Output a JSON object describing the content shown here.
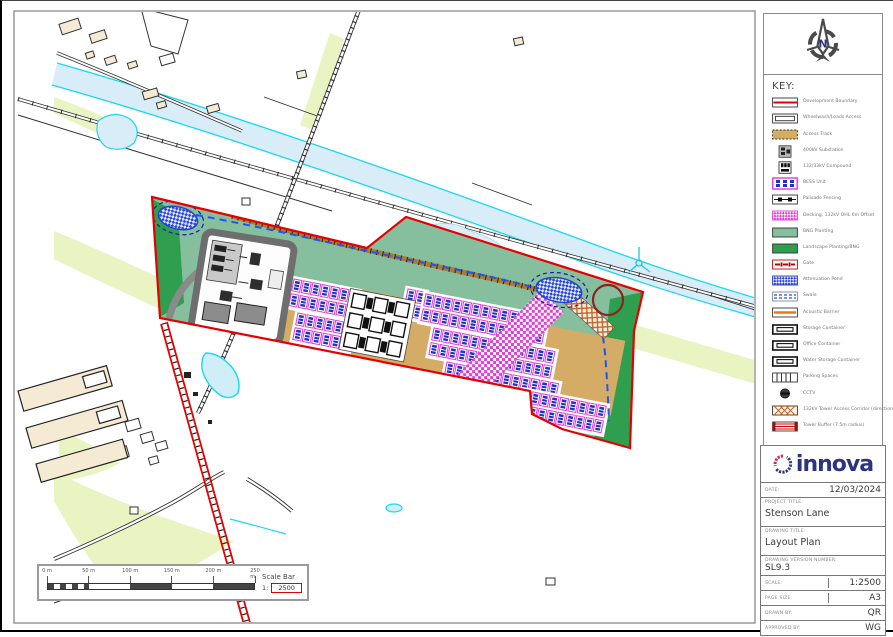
{
  "sheet": {
    "compass": {
      "letter": "N"
    },
    "key": {
      "title": "KEY:",
      "items": [
        {
          "label": "Development Boundary",
          "type": "boundary"
        },
        {
          "label": "Wheelwash/Loads Access",
          "type": "double"
        },
        {
          "label": "Access Track",
          "type": "track"
        },
        {
          "label": "400kV Substation",
          "type": "substation"
        },
        {
          "label": "132/33kV Compound",
          "type": "compound"
        },
        {
          "label": "BESS Unit",
          "type": "bess"
        },
        {
          "label": "Palisade Fencing",
          "type": "palisade"
        },
        {
          "label": "Decking, 132kV OHL 6m Offset",
          "type": "magcheck"
        },
        {
          "label": "BNG Planting",
          "type": "lightgreen"
        },
        {
          "label": "Landscape Planting/BNG",
          "type": "darkgreen"
        },
        {
          "label": "Gate",
          "type": "gate"
        },
        {
          "label": "Attenuation Pond",
          "type": "bluecheck"
        },
        {
          "label": "Swale",
          "type": "swale"
        },
        {
          "label": "Acoustic Barrier",
          "type": "acoustic"
        },
        {
          "label": "Storage Container",
          "type": "container"
        },
        {
          "label": "Office Container",
          "type": "container"
        },
        {
          "label": "Water Storage Container",
          "type": "container"
        },
        {
          "label": "Parking Spaces",
          "type": "parking"
        },
        {
          "label": "CCTV",
          "type": "cctv"
        },
        {
          "label": "132kV Tower Access Corridor (directional)",
          "type": "xhatch"
        },
        {
          "label": "Tower Buffer (7.5m radius)",
          "type": "redhatch"
        }
      ]
    },
    "logo": {
      "text": "innova"
    },
    "titleblock": {
      "date_label": "DATE:",
      "date": "12/03/2024",
      "project_label": "PROJECT TITLE:",
      "project": "Stenson Lane",
      "drawing_label": "DRAWING TITLE:",
      "drawing": "Layout Plan",
      "version_label": "DRAWING VERSION NUMBER:",
      "version": "SL9.3",
      "scale_label": "SCALE:",
      "scale": "1:2500",
      "page_label": "PAGE SIZE:",
      "page": "A3",
      "drawn_label": "DRAWN BY:",
      "drawn": "QR",
      "approved_label": "APPROVED BY:",
      "approved": "WG"
    },
    "scalebar": {
      "ticks": [
        "0 m",
        "50 m",
        "100 m",
        "150 m",
        "200 m",
        "250 m"
      ],
      "title": "Scale Bar",
      "ratio_prefix": "1:",
      "ratio_value": "2500"
    },
    "colors": {
      "boundary_red": "#e60000",
      "bng_light_green": "#86bf9d",
      "landscape_dark_green": "#2f9e4e",
      "track_tan": "#d4ac66",
      "bess_magenta": "#e23ad2",
      "bess_blue": "#2230c8",
      "water_cyan": "#19d7f0",
      "river_fill": "#d8edf8",
      "vegetation_pale": "#e9f4c2",
      "building_beige": "#f5ead3",
      "acoustic_orange": "#e87722",
      "corridor_brown": "#c1652a",
      "logo_navy": "#2b3480",
      "logo_crimson": "#cf2a62"
    },
    "map": {
      "panel_groups": [
        {
          "x": 292,
          "y": 278,
          "rows": 2,
          "cols": 7
        },
        {
          "x": 296,
          "y": 312,
          "rows": 2,
          "cols": 6
        },
        {
          "x": 406,
          "y": 288,
          "rows": 2,
          "cols": 2
        },
        {
          "x": 424,
          "y": 293,
          "rows": 2,
          "cols": 13
        },
        {
          "x": 432,
          "y": 327,
          "rows": 2,
          "cols": 13
        },
        {
          "x": 445,
          "y": 361,
          "rows": 2,
          "cols": 12
        },
        {
          "x": 521,
          "y": 389,
          "rows": 2,
          "cols": 9
        }
      ],
      "site_rotation_deg": 11
    }
  }
}
